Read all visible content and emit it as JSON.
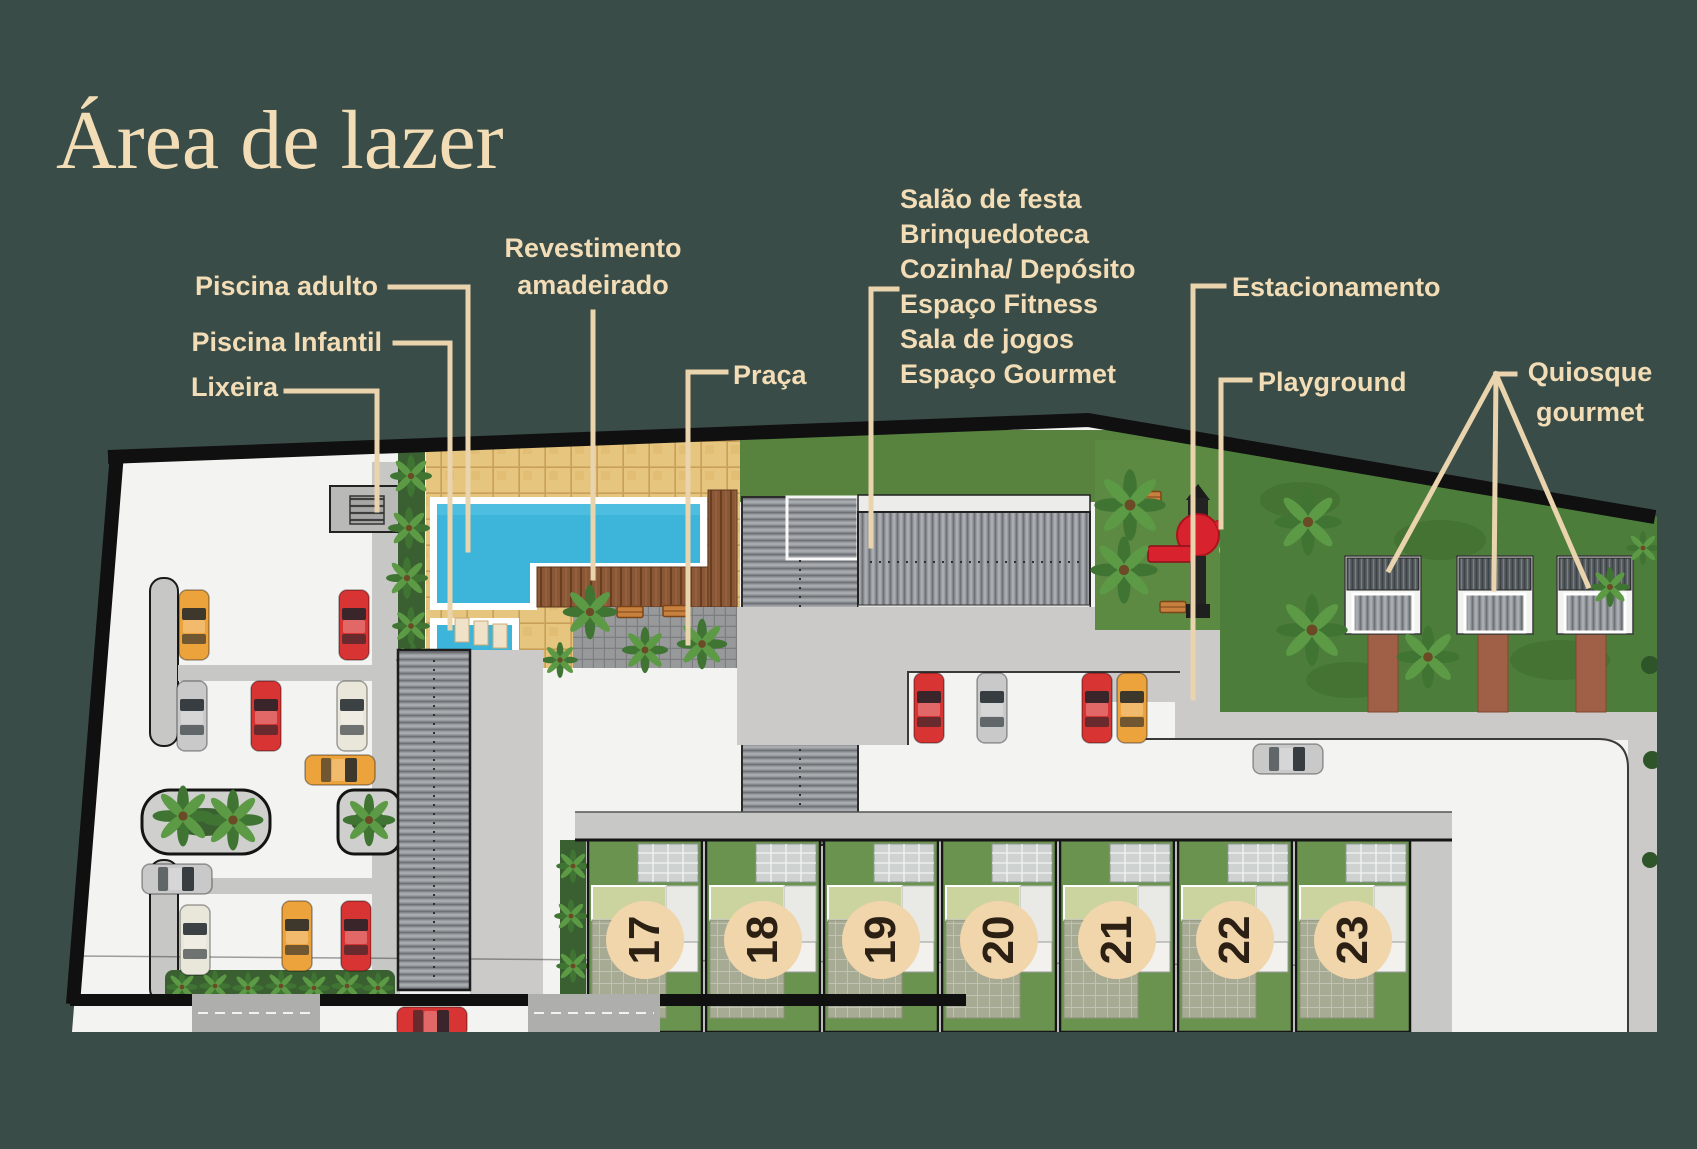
{
  "page": {
    "title": "Área de lazer"
  },
  "callouts": {
    "piscina_adulto": {
      "label": "Piscina adulto"
    },
    "piscina_infantil": {
      "label": "Piscina Infantil"
    },
    "lixeira": {
      "label": "Lixeira"
    },
    "revestimento": {
      "line1": "Revestimento",
      "line2": "amadeirado"
    },
    "praca": {
      "label": "Praça"
    },
    "amenities": {
      "items": [
        "Salão de festa",
        "Brinquedoteca",
        "Cozinha/ Depósito",
        "Espaço Fitness",
        "Sala de jogos",
        "Espaço Gourmet"
      ]
    },
    "estacionamento": {
      "label": "Estacionamento"
    },
    "playground": {
      "label": "Playground"
    },
    "quiosque": {
      "line1": "Quiosque",
      "line2": "gourmet"
    }
  },
  "houses": {
    "units": [
      {
        "number": "17"
      },
      {
        "number": "18"
      },
      {
        "number": "19"
      },
      {
        "number": "20"
      },
      {
        "number": "21"
      },
      {
        "number": "22"
      },
      {
        "number": "23"
      }
    ]
  },
  "colors": {
    "background": "#3a4c47",
    "label_text": "#f2ddb7",
    "leader_line": "#e9d4ae",
    "site_base": "#f3f3f1",
    "pool_water": "#3db4d9",
    "stone_tile": "#e6c57e",
    "wood_deck": "#8a5737",
    "paver_plaza": "#97999b",
    "grass": "#57833f",
    "kiosk_garden_grass": "#4d7d3b",
    "roof_gray": "#9a9da1",
    "concrete": "#cbcac8",
    "brick_path": "#a05f47",
    "house_circle": "#f1d5ab",
    "house_roof": "#cbd49e",
    "playground_equipment": "#d8232e",
    "bench_orange": "#c8803f",
    "car_red": "#d93434",
    "car_orange": "#eda33c",
    "car_silver": "#c9c9c9",
    "car_cream": "#e9e6da",
    "site_border": "#101010"
  }
}
